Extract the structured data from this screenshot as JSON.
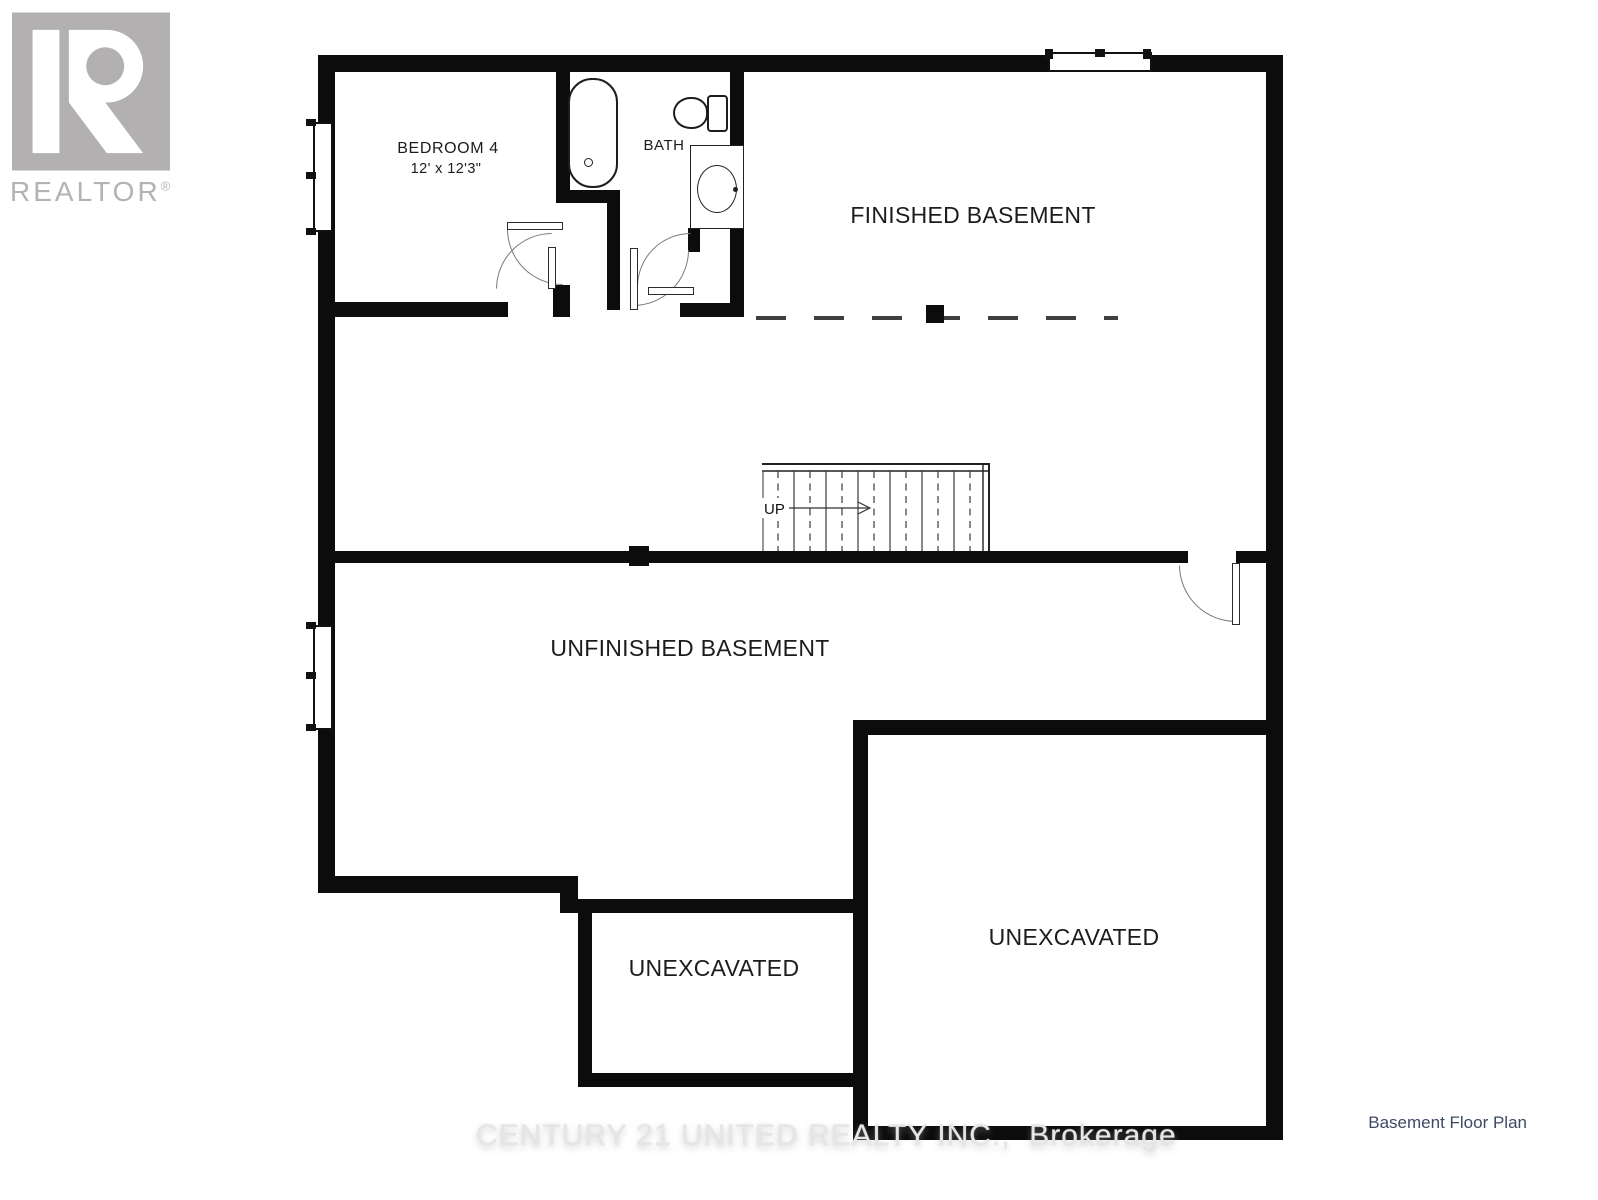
{
  "branding": {
    "logo_text": "REALTOR",
    "logo_reg": "®",
    "logo_color": "#b2b0b1"
  },
  "plan": {
    "rooms": {
      "bedroom4": {
        "name": "BEDROOM 4",
        "dimensions": "12' x 12'3\""
      },
      "bath": {
        "name": "BATH"
      },
      "finished_basement": {
        "name": "FINISHED BASEMENT"
      },
      "unfinished_basement": {
        "name": "UNFINISHED BASEMENT"
      },
      "unexcavated_left": {
        "name": "UNEXCAVATED"
      },
      "unexcavated_right": {
        "name": "UNEXCAVATED"
      }
    },
    "stairs": {
      "direction_label": "UP"
    }
  },
  "watermark": {
    "text": "CENTURY 21 UNITED REALTY INC.,  Brokerage"
  },
  "caption": {
    "text": "Basement Floor Plan",
    "color": "#3c4a66"
  },
  "colors": {
    "wall": "#0c0c0c",
    "line": "#333333",
    "dash": "#3f3f3f",
    "logo_gray": "#b2b0b1"
  }
}
